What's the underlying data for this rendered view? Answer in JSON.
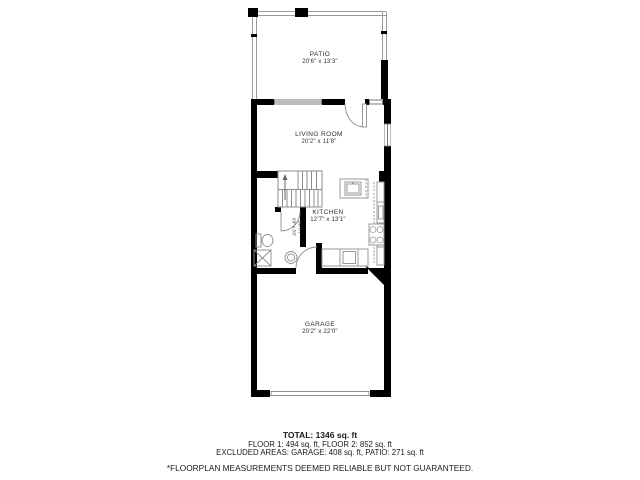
{
  "floorplan": {
    "rooms": {
      "patio": {
        "name": "PATIO",
        "dims": "20'6\" x 13'3\""
      },
      "living": {
        "name": "LIVING ROOM",
        "dims": "20'2\" x 11'8\""
      },
      "kitchen": {
        "name": "KITCHEN",
        "dims": "12'7\" x 13'1\""
      },
      "bath": {
        "name": "BATH",
        "dims": "6'8\" x 3'6\""
      },
      "garage": {
        "name": "GARAGE",
        "dims": "20'2\" x 22'0\""
      }
    },
    "summary": {
      "total": "TOTAL: 1346 sq. ft",
      "floors": "FLOOR 1: 494 sq. ft, FLOOR 2: 852 sq. ft",
      "excluded": "EXCLUDED AREAS: GARAGE: 408 sq. ft, PATIO: 271 sq. ft",
      "disclaimer": "*FLOORPLAN MEASUREMENTS DEEMED RELIABLE BUT NOT GUARANTEED."
    },
    "colors": {
      "wall": "#000000",
      "thin_line": "#8c8c8c",
      "text": "#2e2e2e"
    }
  }
}
